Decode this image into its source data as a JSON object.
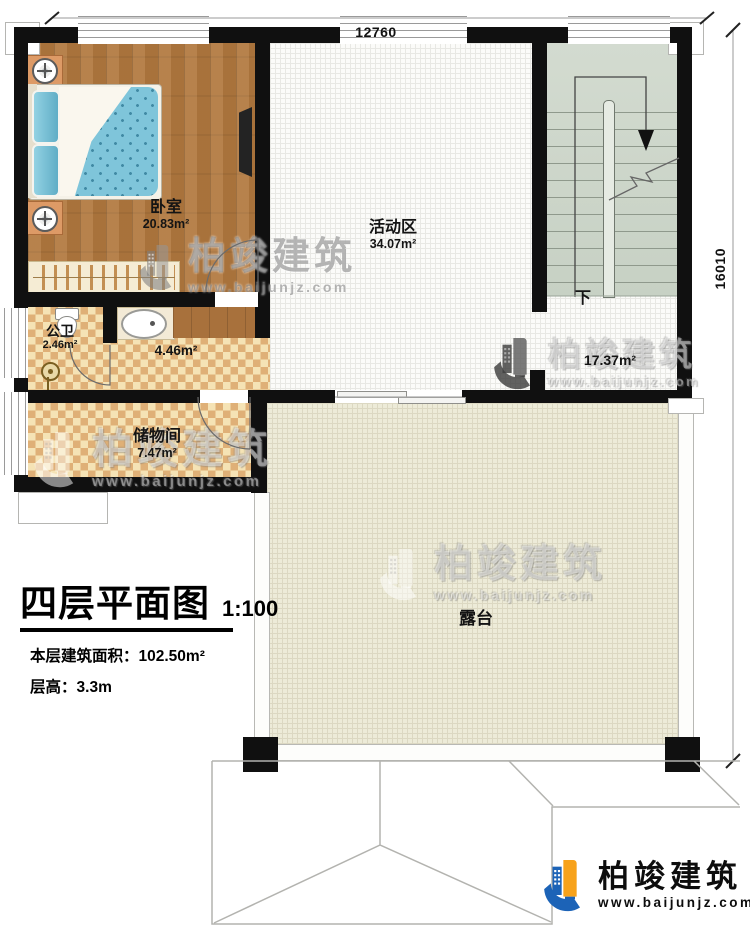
{
  "dimensions": {
    "top": "12760",
    "right": "16010"
  },
  "rooms": {
    "bedroom": {
      "name": "卧室",
      "area": "20.83m²"
    },
    "activity": {
      "name": "活动区",
      "area": "34.07m²"
    },
    "bathroom": {
      "name": "公卫",
      "area": "2.46m²"
    },
    "hallway": {
      "area": "4.46m²"
    },
    "storage": {
      "name": "储物间",
      "area": "7.47m²"
    },
    "stairhall": {
      "area": "17.37m²"
    },
    "terrace": {
      "name": "露台"
    },
    "stairs_down": "下"
  },
  "title_block": {
    "title": "四层平面图",
    "scale": "1:100",
    "area_label": "本层建筑面积：",
    "area_value": "102.50m²",
    "height_label": "层高：",
    "height_value": "3.3m"
  },
  "branding": {
    "company": "柏竣建筑",
    "website": "www.baijunjz.com"
  },
  "colors": {
    "wall": "#101010",
    "wood_floor": "#b2793f",
    "tile_light": "#f5e3b5",
    "tile_dark": "#dfb077",
    "stair_floor": "#ccd5c8",
    "terrace_floor": "#edebd8",
    "activity_floor": "#fbfbf9",
    "logo_blue": "#1c63b7",
    "logo_orange": "#f7a21b",
    "bed_blue": "#7fc5da"
  }
}
